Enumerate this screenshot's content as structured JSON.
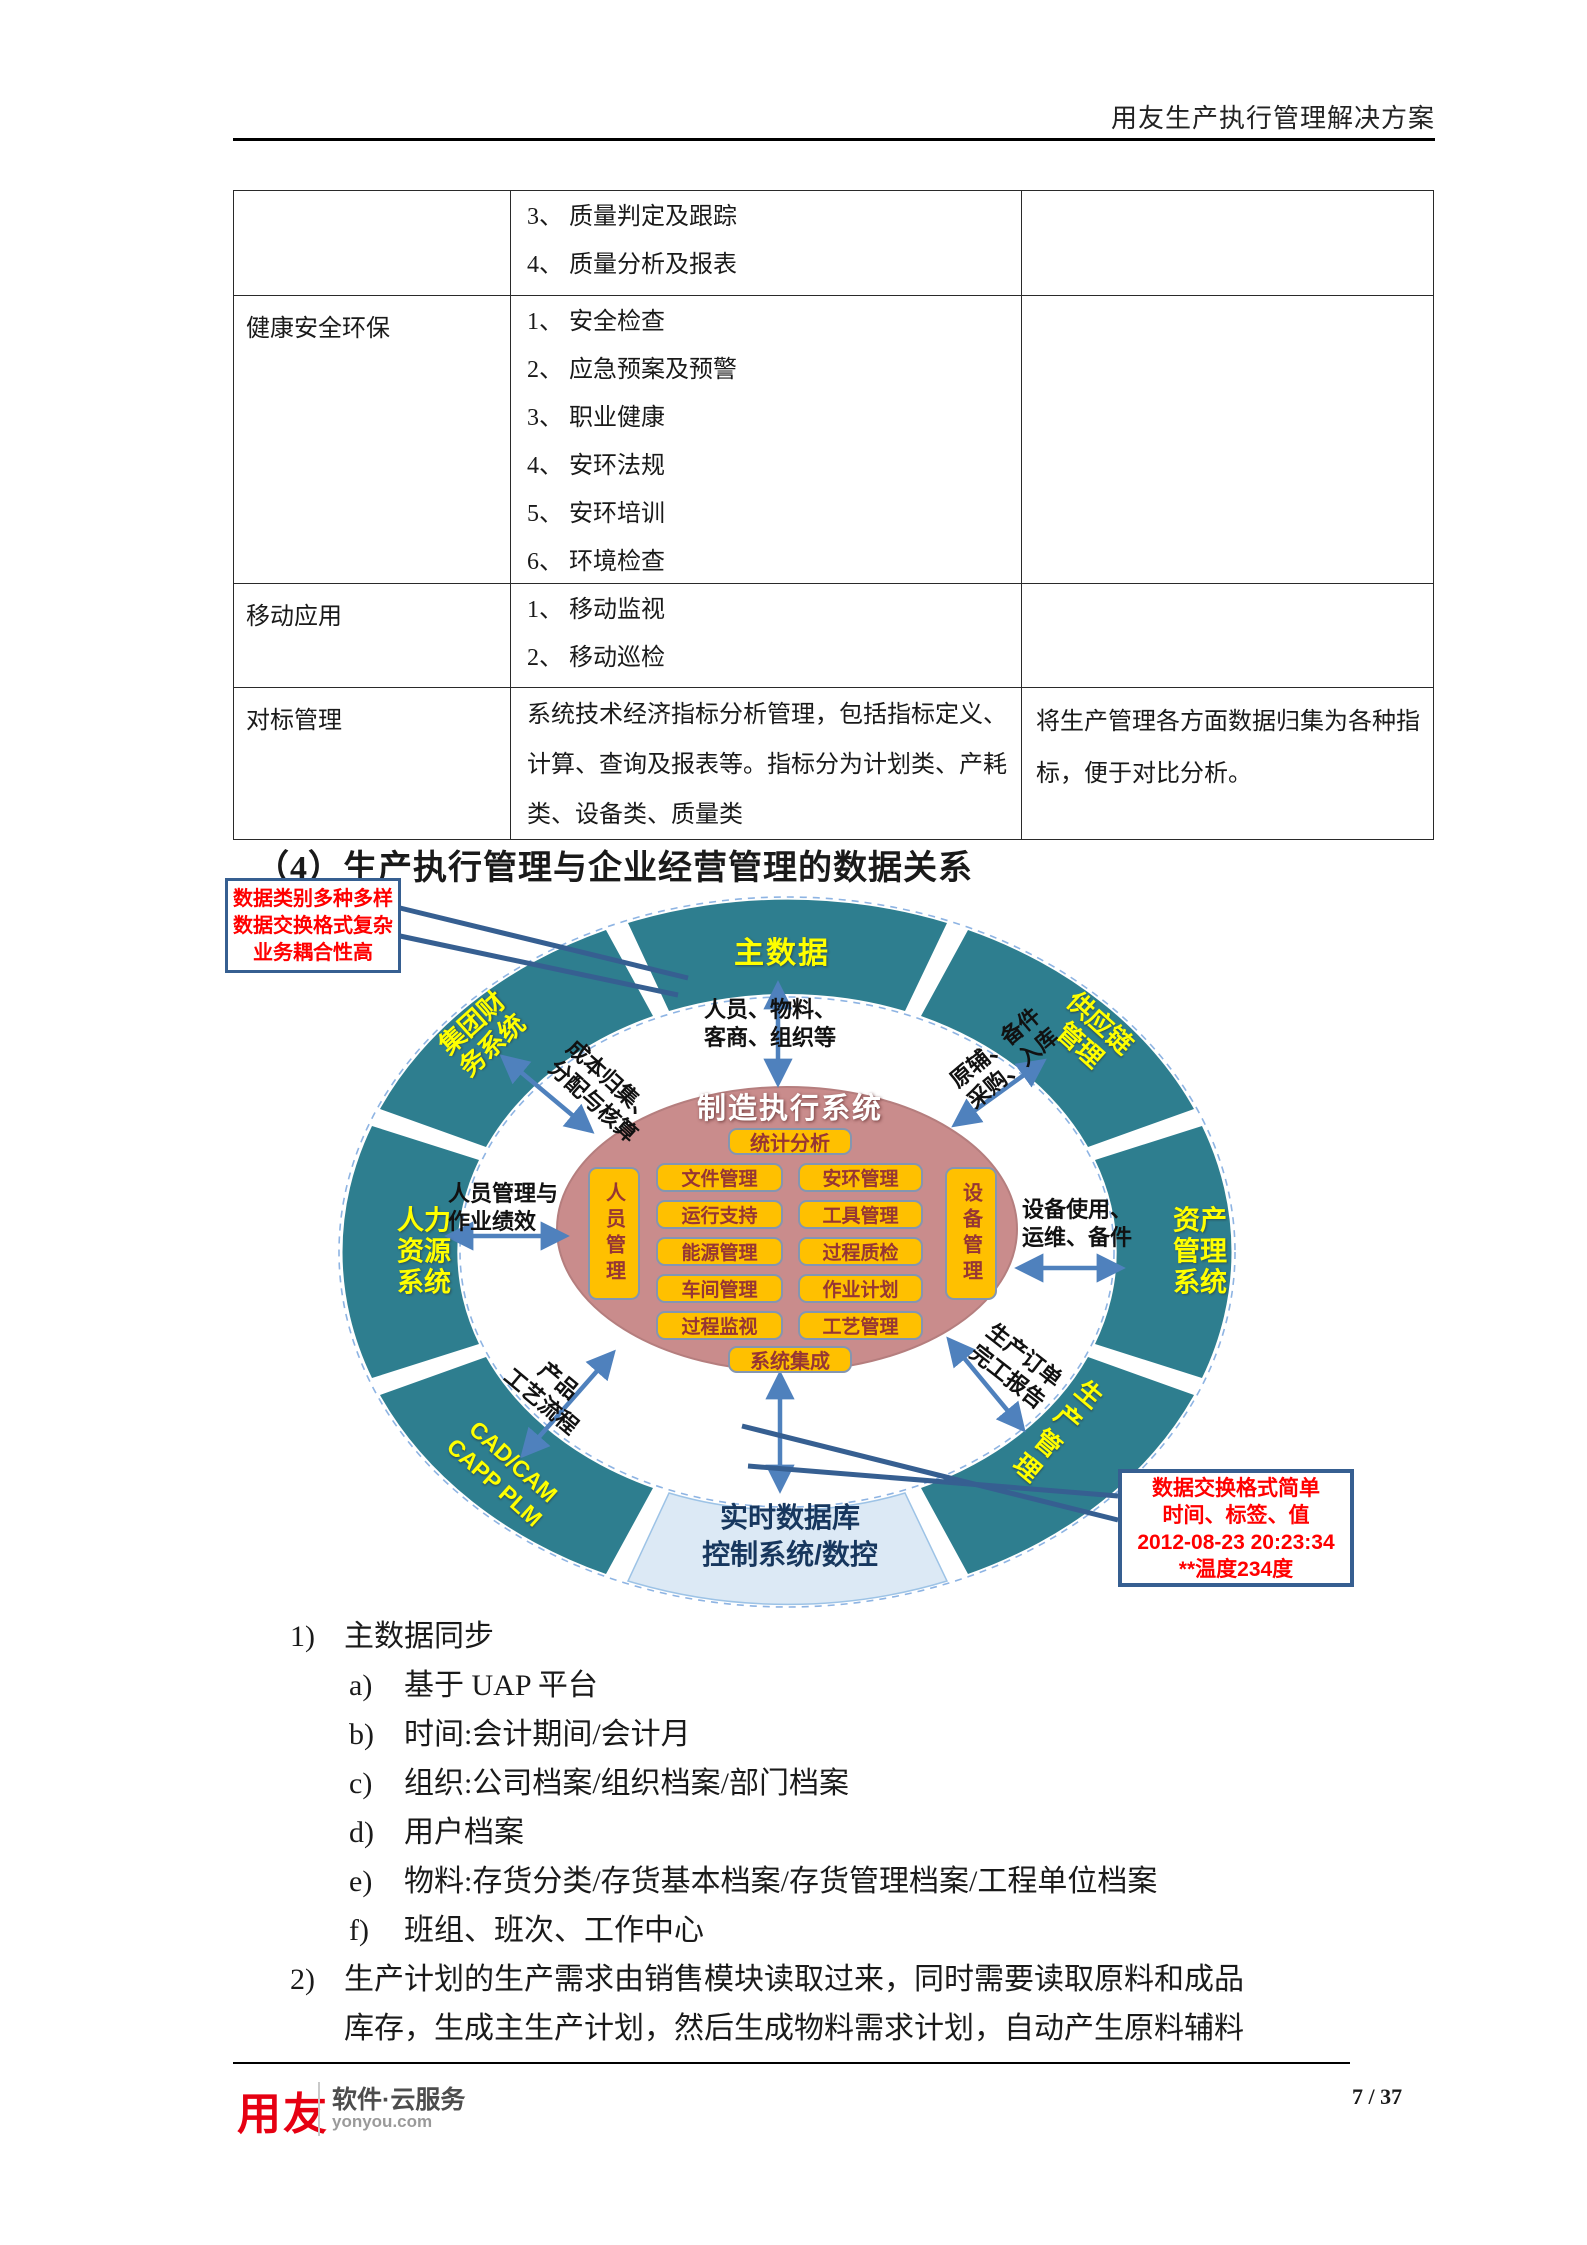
{
  "colors": {
    "teal": "#2e7e8f",
    "rose": "#c98c8c",
    "orange": "#ffc000",
    "orange_text": "#963634",
    "arrow_blue": "#4f81bd",
    "pointer_blue": "#365f91",
    "light_blue_arc": "#dce9f5",
    "navy_text": "#17375e",
    "callout_red": "#ff0000",
    "label_yellow": "#ffff00",
    "logo_red": "#e60012"
  },
  "header": {
    "title": "用友生产执行管理解决方案"
  },
  "table": {
    "rows": [
      {
        "label": "",
        "items": [
          "3、 质量判定及跟踪",
          "4、 质量分析及报表"
        ],
        "note": ""
      },
      {
        "label": "健康安全环保",
        "items": [
          "1、 安全检查",
          "2、 应急预案及预警",
          "3、 职业健康",
          "4、 安环法规",
          "5、 安环培训",
          "6、 环境检查"
        ],
        "note": ""
      },
      {
        "label": "移动应用",
        "items": [
          "1、 移动监视",
          "2、 移动巡检"
        ],
        "note": ""
      },
      {
        "label": "对标管理",
        "text": "系统技术经济指标分析管理，包括指标定义、计算、查询及报表等。指标分为计划类、产耗类、设备类、质量类",
        "note": "将生产管理各方面数据归集为各种指标，便于对比分析。"
      }
    ]
  },
  "section": {
    "heading": "（4）生产执行管理与企业经营管理的数据关系"
  },
  "diagram": {
    "callout_top_left": {
      "lines": [
        "数据类别多种多样",
        "数据交换格式复杂",
        "业务耦合性高"
      ]
    },
    "callout_bottom_right": {
      "lines": [
        "数据交换格式简单",
        "时间、标签、值",
        "2012-08-23 20:23:34",
        "**温度234度"
      ]
    },
    "ring": {
      "top": "主数据",
      "top_right": [
        "供应链",
        "管理"
      ],
      "right": [
        "资产",
        "管理",
        "系统"
      ],
      "bottom_right": "生产管理",
      "bottom": [
        "实时数据库",
        "控制系统/数控"
      ],
      "bottom_left": [
        "CAD/CAM",
        "CAPP PLM"
      ],
      "left": [
        "人力",
        "资源",
        "系统"
      ],
      "top_left": [
        "集团财",
        "务系统"
      ]
    },
    "center": {
      "title": "制造执行系统",
      "top_box": "统计分析",
      "bottom_box": "系统集成",
      "left_vertical": "人员管理",
      "right_vertical": "设备管理",
      "left_col": [
        "文件管理",
        "运行支持",
        "能源管理",
        "车间管理",
        "过程监视"
      ],
      "right_col": [
        "安环管理",
        "工具管理",
        "过程质检",
        "作业计划",
        "工艺管理"
      ]
    },
    "links": {
      "top": [
        "人员、物料、",
        "客商、组织等"
      ],
      "top_left": [
        "成本归集、",
        "分配与核算"
      ],
      "left": [
        "人员管理与",
        "作业绩效"
      ],
      "bottom_left": [
        "产品",
        "工艺流程"
      ],
      "top_right": [
        "原辅、备件",
        "采购、入库"
      ],
      "right": [
        "设备使用、",
        "运维、备件"
      ],
      "bottom_right": [
        "生产订单",
        "完工报告"
      ]
    }
  },
  "list": {
    "item1": {
      "marker": "1)",
      "text": "主数据同步"
    },
    "subs": [
      {
        "marker": "a)",
        "text": "基于 UAP 平台"
      },
      {
        "marker": "b)",
        "text": "时间:会计期间/会计月"
      },
      {
        "marker": "c)",
        "text": "组织:公司档案/组织档案/部门档案"
      },
      {
        "marker": "d)",
        "text": "用户档案"
      },
      {
        "marker": "e)",
        "text": "物料:存货分类/存货基本档案/存货管理档案/工程单位档案"
      },
      {
        "marker": "f)",
        "text": "班组、班次、工作中心"
      }
    ],
    "item2": {
      "marker": "2)",
      "line1": "生产计划的生产需求由销售模块读取过来，同时需要读取原料和成品",
      "line2": "库存，生成主生产计划，然后生成物料需求计划，自动产生原料辅料"
    }
  },
  "footer": {
    "logo": "用友",
    "tagline": "软件·云服务",
    "site": "yonyou.com",
    "page": "7 / 37"
  }
}
